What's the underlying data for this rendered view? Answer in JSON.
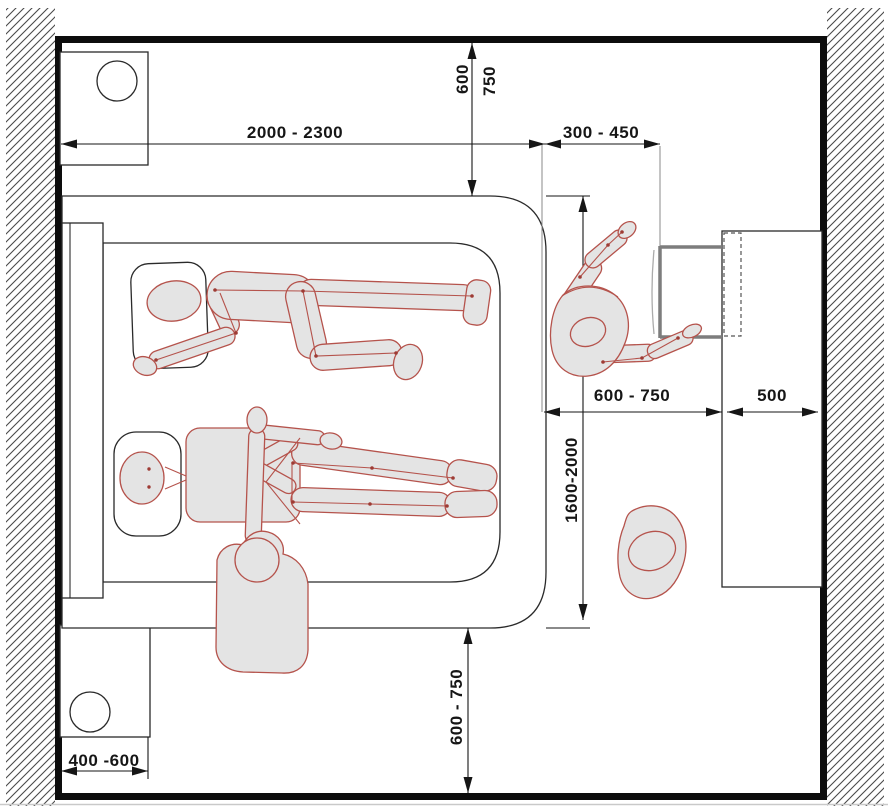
{
  "diagram_type": "bedroom-ergonomics-plan",
  "colors": {
    "wall": "#0d0d0d",
    "hatch_line": "#4a4a4a",
    "drawing_line": "#161616",
    "extension_line": "#8a8a8a",
    "figure_stroke": "#b5534c",
    "figure_fill": "#e4e4e4",
    "door_gray": "#7d7d7d"
  },
  "dimensions": {
    "bed_width": "2000 - 2300",
    "head_clearance_min": "600",
    "head_clearance_max": "750",
    "bed_to_wardrobe": "300 - 450",
    "wardrobe_access": "600 - 750",
    "wardrobe_depth": "500",
    "bed_length": "1600-2000",
    "foot_clearance": "600 - 750",
    "nightstand_width": "400 -600"
  },
  "furniture": {
    "bed": "double-bed-plan",
    "headboard": "headboard",
    "pillows": 2,
    "nightstand_top_left": "nightstand-with-lamp",
    "nightstand_bottom_left": "nightstand-with-lamp",
    "wardrobe": "wardrobe-with-open-door",
    "ottoman": "ottoman-pouf"
  },
  "figures": {
    "person_1": "person-lying-on-side",
    "person_2": "person-lying-on-back",
    "person_3": "person-sitting-on-bed-edge",
    "person_4": "person-reaching-into-wardrobe"
  }
}
